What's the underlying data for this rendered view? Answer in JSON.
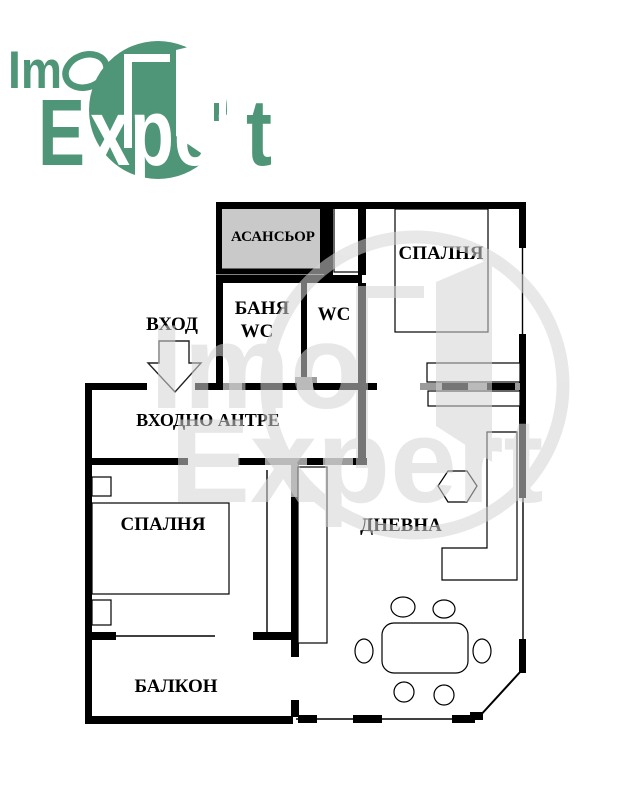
{
  "logo": {
    "brand_green": "#4E9677",
    "fragments": {
      "im": "Im",
      "e": "E",
      "xper": "xper",
      "t": "t"
    }
  },
  "floor_plan": {
    "labels": {
      "elevator": "АСАНСЬОР",
      "bathroom_line1": "БАНЯ",
      "bathroom_line2": "WC",
      "wc": "WC",
      "entrance": "ВХОД",
      "entrance_hall": "ВХОДНО АНТРЕ",
      "bedroom_top": "СПАЛНЯ",
      "bedroom_left": "СПАЛНЯ",
      "living_room": "ДНЕВНА",
      "balcony": "БАЛКОН"
    },
    "colors": {
      "wall": "#000000",
      "elevator_fill": "#C9C9C9",
      "door_gray": "#9B9B9B",
      "wc_label_gray": "#9A9A9A"
    }
  },
  "watermark": {
    "word1": "Imo",
    "word2": "Expert"
  }
}
